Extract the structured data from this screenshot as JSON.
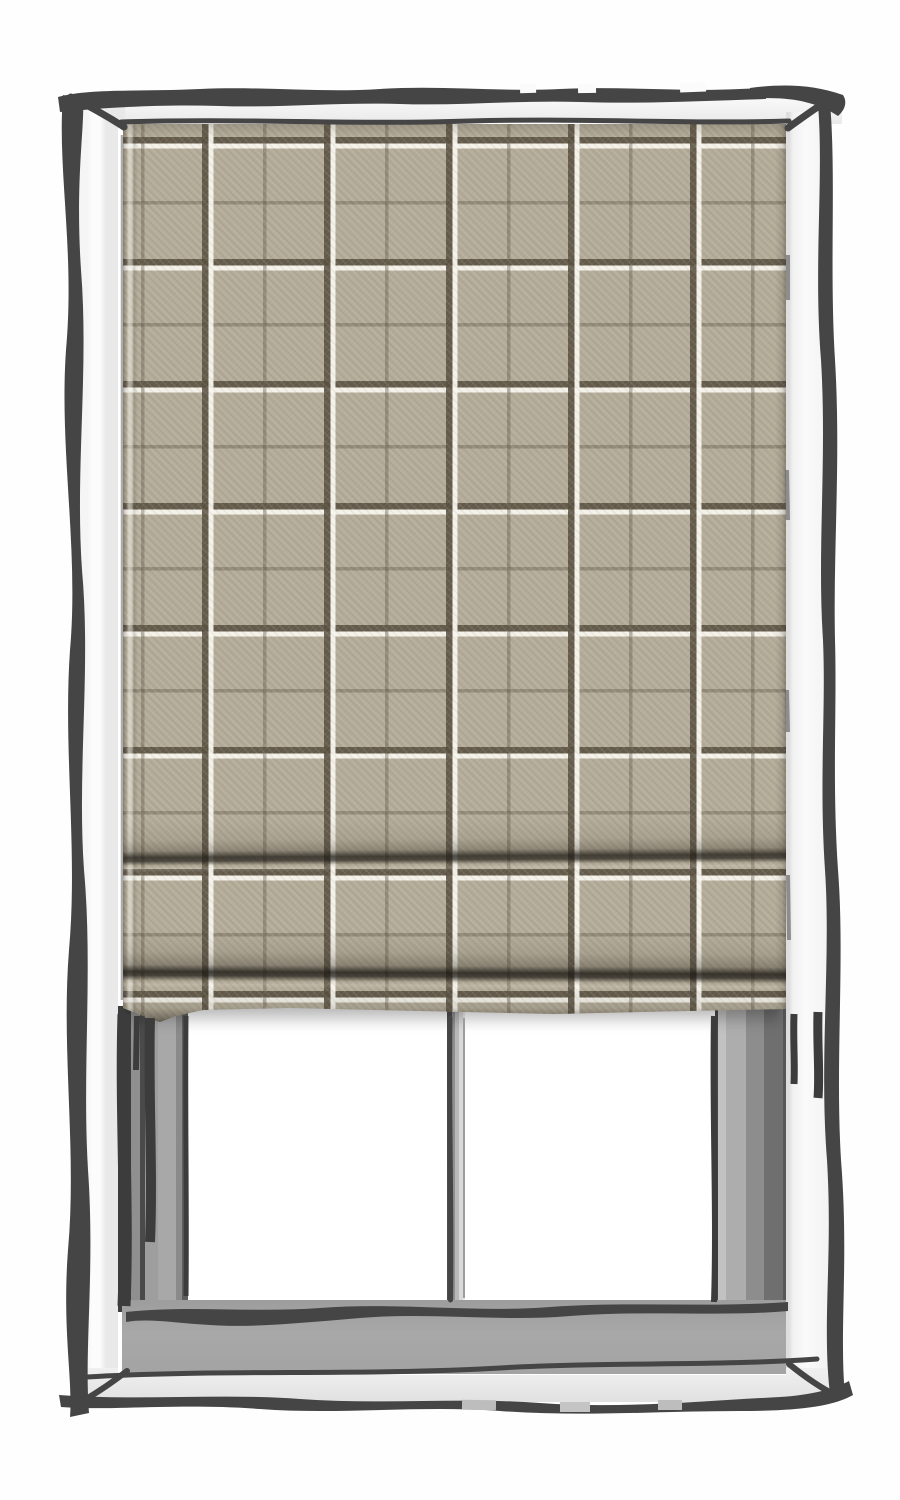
{
  "scene": {
    "subject": "Hand-sketched white window frame with a lowered tartan roman blind",
    "style": "ink outline illustration with flat gray shading",
    "blind": {
      "type": "roman blind",
      "coverage": "lowered about three quarters of the window",
      "fold_count": 2,
      "fabric_pattern": "beige windowpane tartan check",
      "pattern_repeat_px": 122,
      "pattern_lines": "bold brown line paired with a white line, thin brown line at half repeat"
    },
    "window": {
      "panes_visible": 2,
      "mullion": "single vertical divider below the blind",
      "sill": "flat gray sill across the bottom"
    }
  },
  "theme": {
    "page_bg": "#fefefe",
    "ink": "#454545",
    "frame_face": "#f2f2f2",
    "frame_face_shaded": "#e7e7e7",
    "pane_white": "#ffffff",
    "jamb_gray": "#9b9b9b",
    "sill_gray": "#a8a8a8",
    "fabric_base": "#b3ab98",
    "fabric_dark_line": "#58503f",
    "fabric_white_line": "#f7f5ed",
    "fold_shadow": "#2e2a22"
  }
}
